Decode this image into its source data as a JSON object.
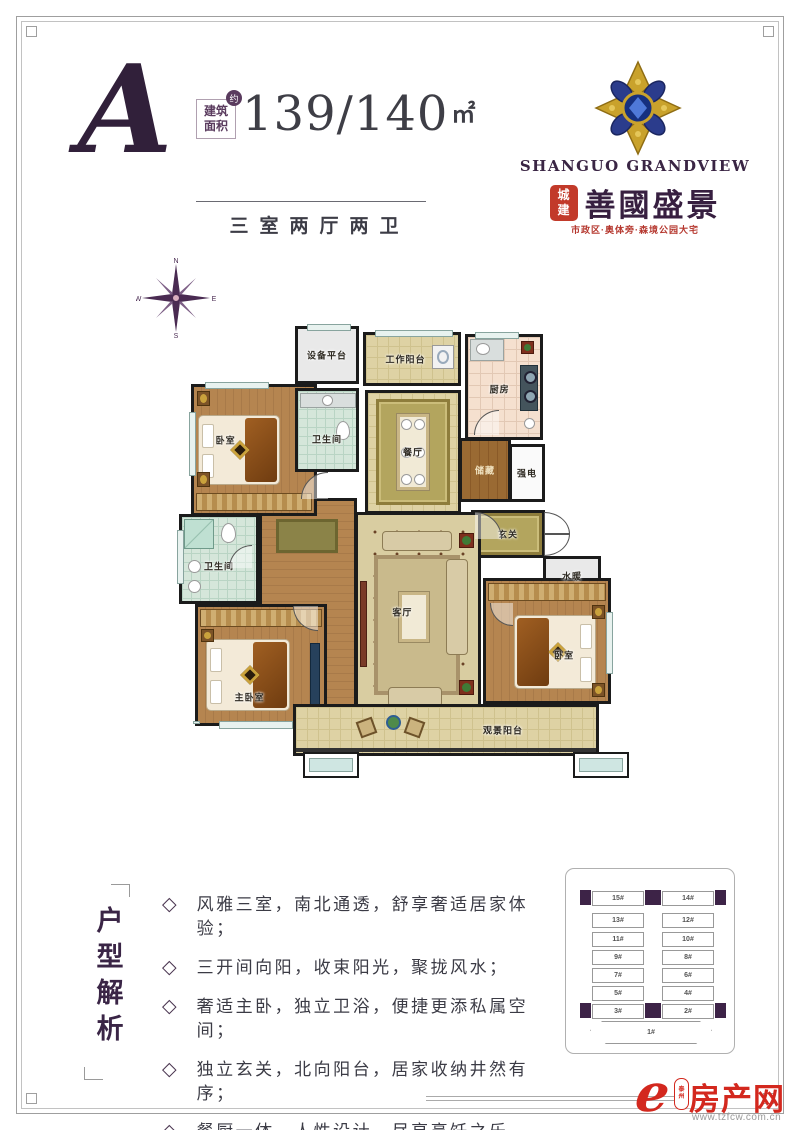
{
  "unit": {
    "letter": "A",
    "area_label_line1": "建筑",
    "area_label_line2": "面积",
    "area_badge": "约",
    "area_value": "139/140",
    "area_unit": "㎡",
    "layout_type": "三室两厅两卫"
  },
  "brand": {
    "name_en": "SHANGUO GRANDVIEW",
    "seal_line1": "城",
    "seal_line2": "建",
    "name_cn": "善國盛景",
    "tagline": "市政区·奥体旁·森境公园大宅"
  },
  "compass": {
    "n": "N",
    "e": "E",
    "s": "S",
    "w": "W"
  },
  "plan": {
    "rooms": [
      {
        "label": "卧室"
      },
      {
        "label": "设备平台"
      },
      {
        "label": "工作阳台"
      },
      {
        "label": "厨房"
      },
      {
        "label": "卫生间"
      },
      {
        "label": "餐厅"
      },
      {
        "label": "储藏"
      },
      {
        "label": "强电"
      },
      {
        "label": "玄关"
      },
      {
        "label": "水暖"
      },
      {
        "label": "卫生间"
      },
      {
        "label": "主卧室"
      },
      {
        "label": "客厅"
      },
      {
        "label": "卧室"
      },
      {
        "label": "观景阳台"
      }
    ]
  },
  "analysis": {
    "title_vertical": "户型解析",
    "bullet": "◇",
    "items": [
      "风雅三室，南北通透，舒享奢适居家体验；",
      "三开间向阳，收束阳光，聚拢风水；",
      "奢适主卧，独立卫浴，便捷更添私属空间；",
      "独立玄关，北向阳台，居家收纳井然有序；",
      "餐厨一体，人性设计，尽享烹饪之乐。"
    ]
  },
  "siteplan": {
    "left_column": [
      "15#",
      "13#",
      "11#",
      "9#",
      "7#",
      "5#",
      "3#"
    ],
    "right_column": [
      "14#",
      "12#",
      "10#",
      "8#",
      "6#",
      "4#",
      "2#"
    ],
    "bottom": "1#"
  },
  "footer": {
    "logo_letter": "e",
    "seal_line1": "泰",
    "seal_line2": "州",
    "site_name": "房产网",
    "site_url": "www.tzfcw.com.cn"
  },
  "colors": {
    "brand_purple": "#371f40",
    "gold": "#c9a22c",
    "seal_red": "#c23a2a",
    "logo_red": "#d3281e",
    "wall_black": "#1b1b1b"
  }
}
